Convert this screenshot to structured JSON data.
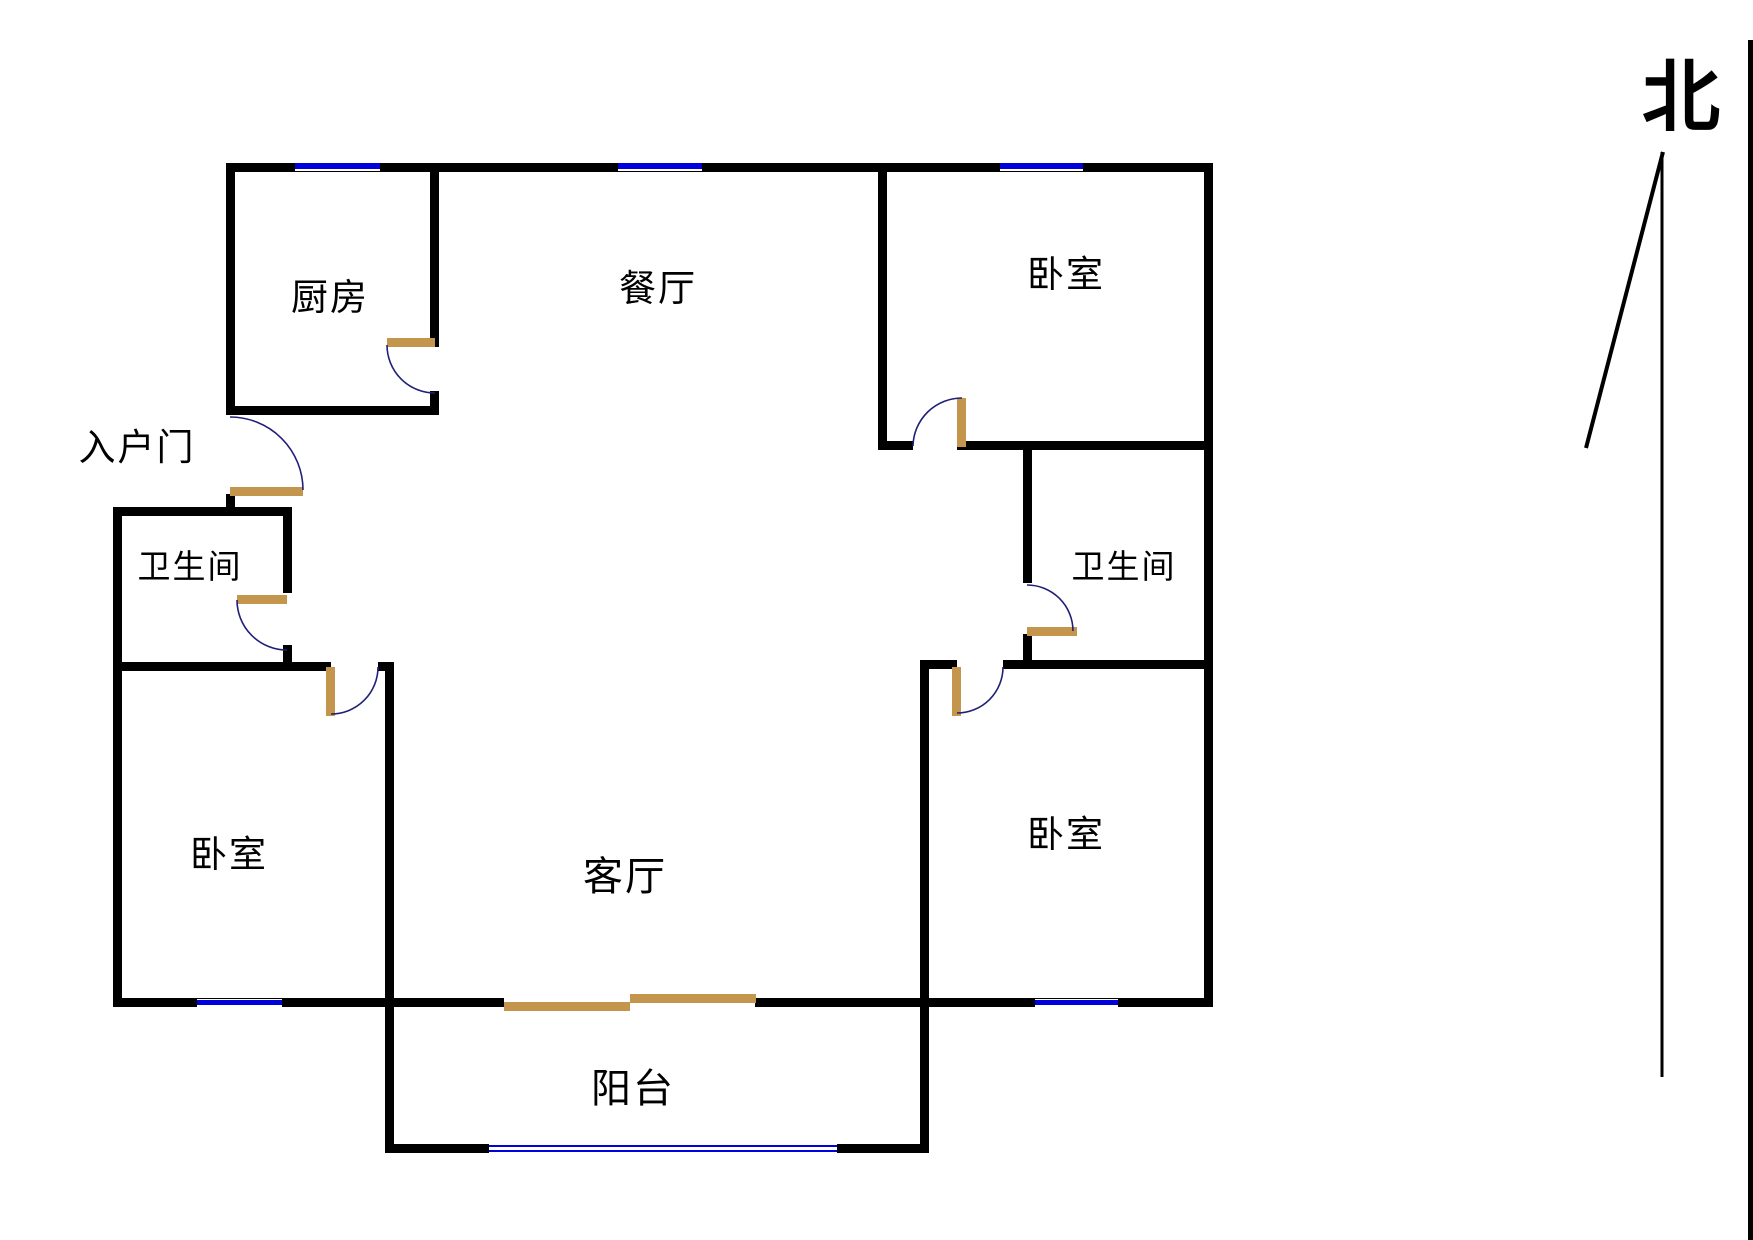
{
  "figure": "apartment-floor-plan",
  "colors": {
    "wall": "#000000",
    "door_panel": "#C4964D",
    "window": "#0101DC",
    "door_arc": "#202077",
    "background": "#FFFFFF",
    "text": "#000000"
  },
  "compass": {
    "label": "北"
  },
  "rooms": [
    {
      "id": "kitchen",
      "label": "厨房"
    },
    {
      "id": "dining",
      "label": "餐厅"
    },
    {
      "id": "bedroom-top-right",
      "label": "卧室"
    },
    {
      "id": "entry-door",
      "label": "入户门"
    },
    {
      "id": "bathroom-left",
      "label": "卫生间"
    },
    {
      "id": "bathroom-right",
      "label": "卫生间"
    },
    {
      "id": "bedroom-bottom-left",
      "label": "卧室"
    },
    {
      "id": "living",
      "label": "客厅"
    },
    {
      "id": "bedroom-bottom-right",
      "label": "卧室"
    },
    {
      "id": "balcony",
      "label": "阳台"
    }
  ]
}
